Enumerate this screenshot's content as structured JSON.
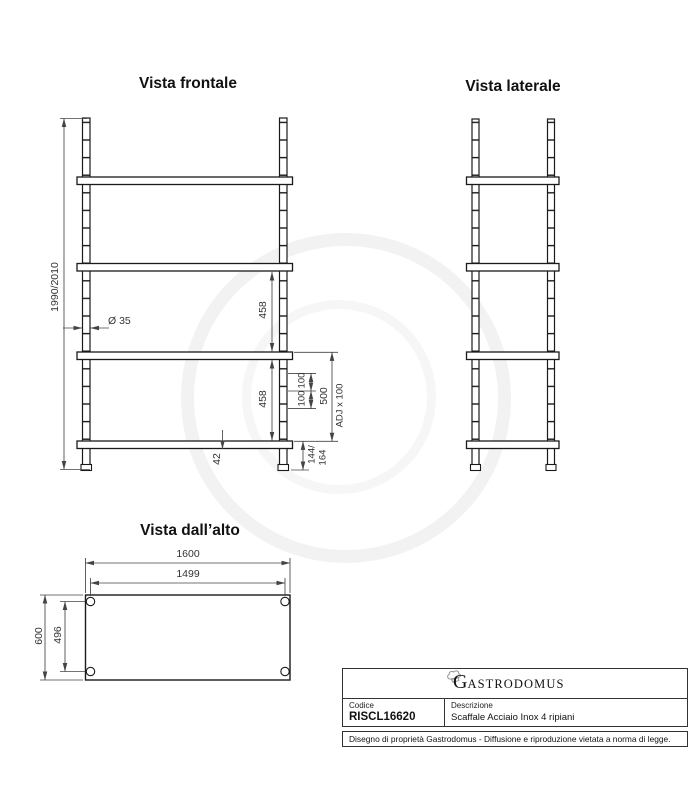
{
  "drawing": {
    "front": {
      "title": "Vista frontale",
      "dim_total_height": "1990/2010",
      "dim_diameter": "Ø 35",
      "dim_gap1": "458",
      "dim_gap2": "458",
      "dim_pitch1": "100",
      "dim_pitch2": "100",
      "dim_span": "500",
      "dim_adjust": "ADJ x 100",
      "dim_thickness": "42",
      "dim_base_line1": "144/",
      "dim_base_line2": "164"
    },
    "side": {
      "title": "Vista laterale"
    },
    "top": {
      "title": "Vista dall’alto",
      "dim_width": "1600",
      "dim_width_inner": "1499",
      "dim_depth": "600",
      "dim_depth_inner": "496"
    },
    "titleblock": {
      "brand_initial": "G",
      "brand_rest": "ASTRODOMUS",
      "code_label": "Codice",
      "code_value": "RISCL16620",
      "description_label": "Descrizione",
      "description_value": "Scaffale Acciaio Inox 4 ripiani",
      "disclaimer": "Disegno di proprietà Gastrodomus -  Diffusione e riproduzione vietata a norma di legge."
    },
    "colors": {
      "line": "#1a1a1a",
      "dim": "#444444",
      "watermark": "#f2f2f2"
    }
  }
}
